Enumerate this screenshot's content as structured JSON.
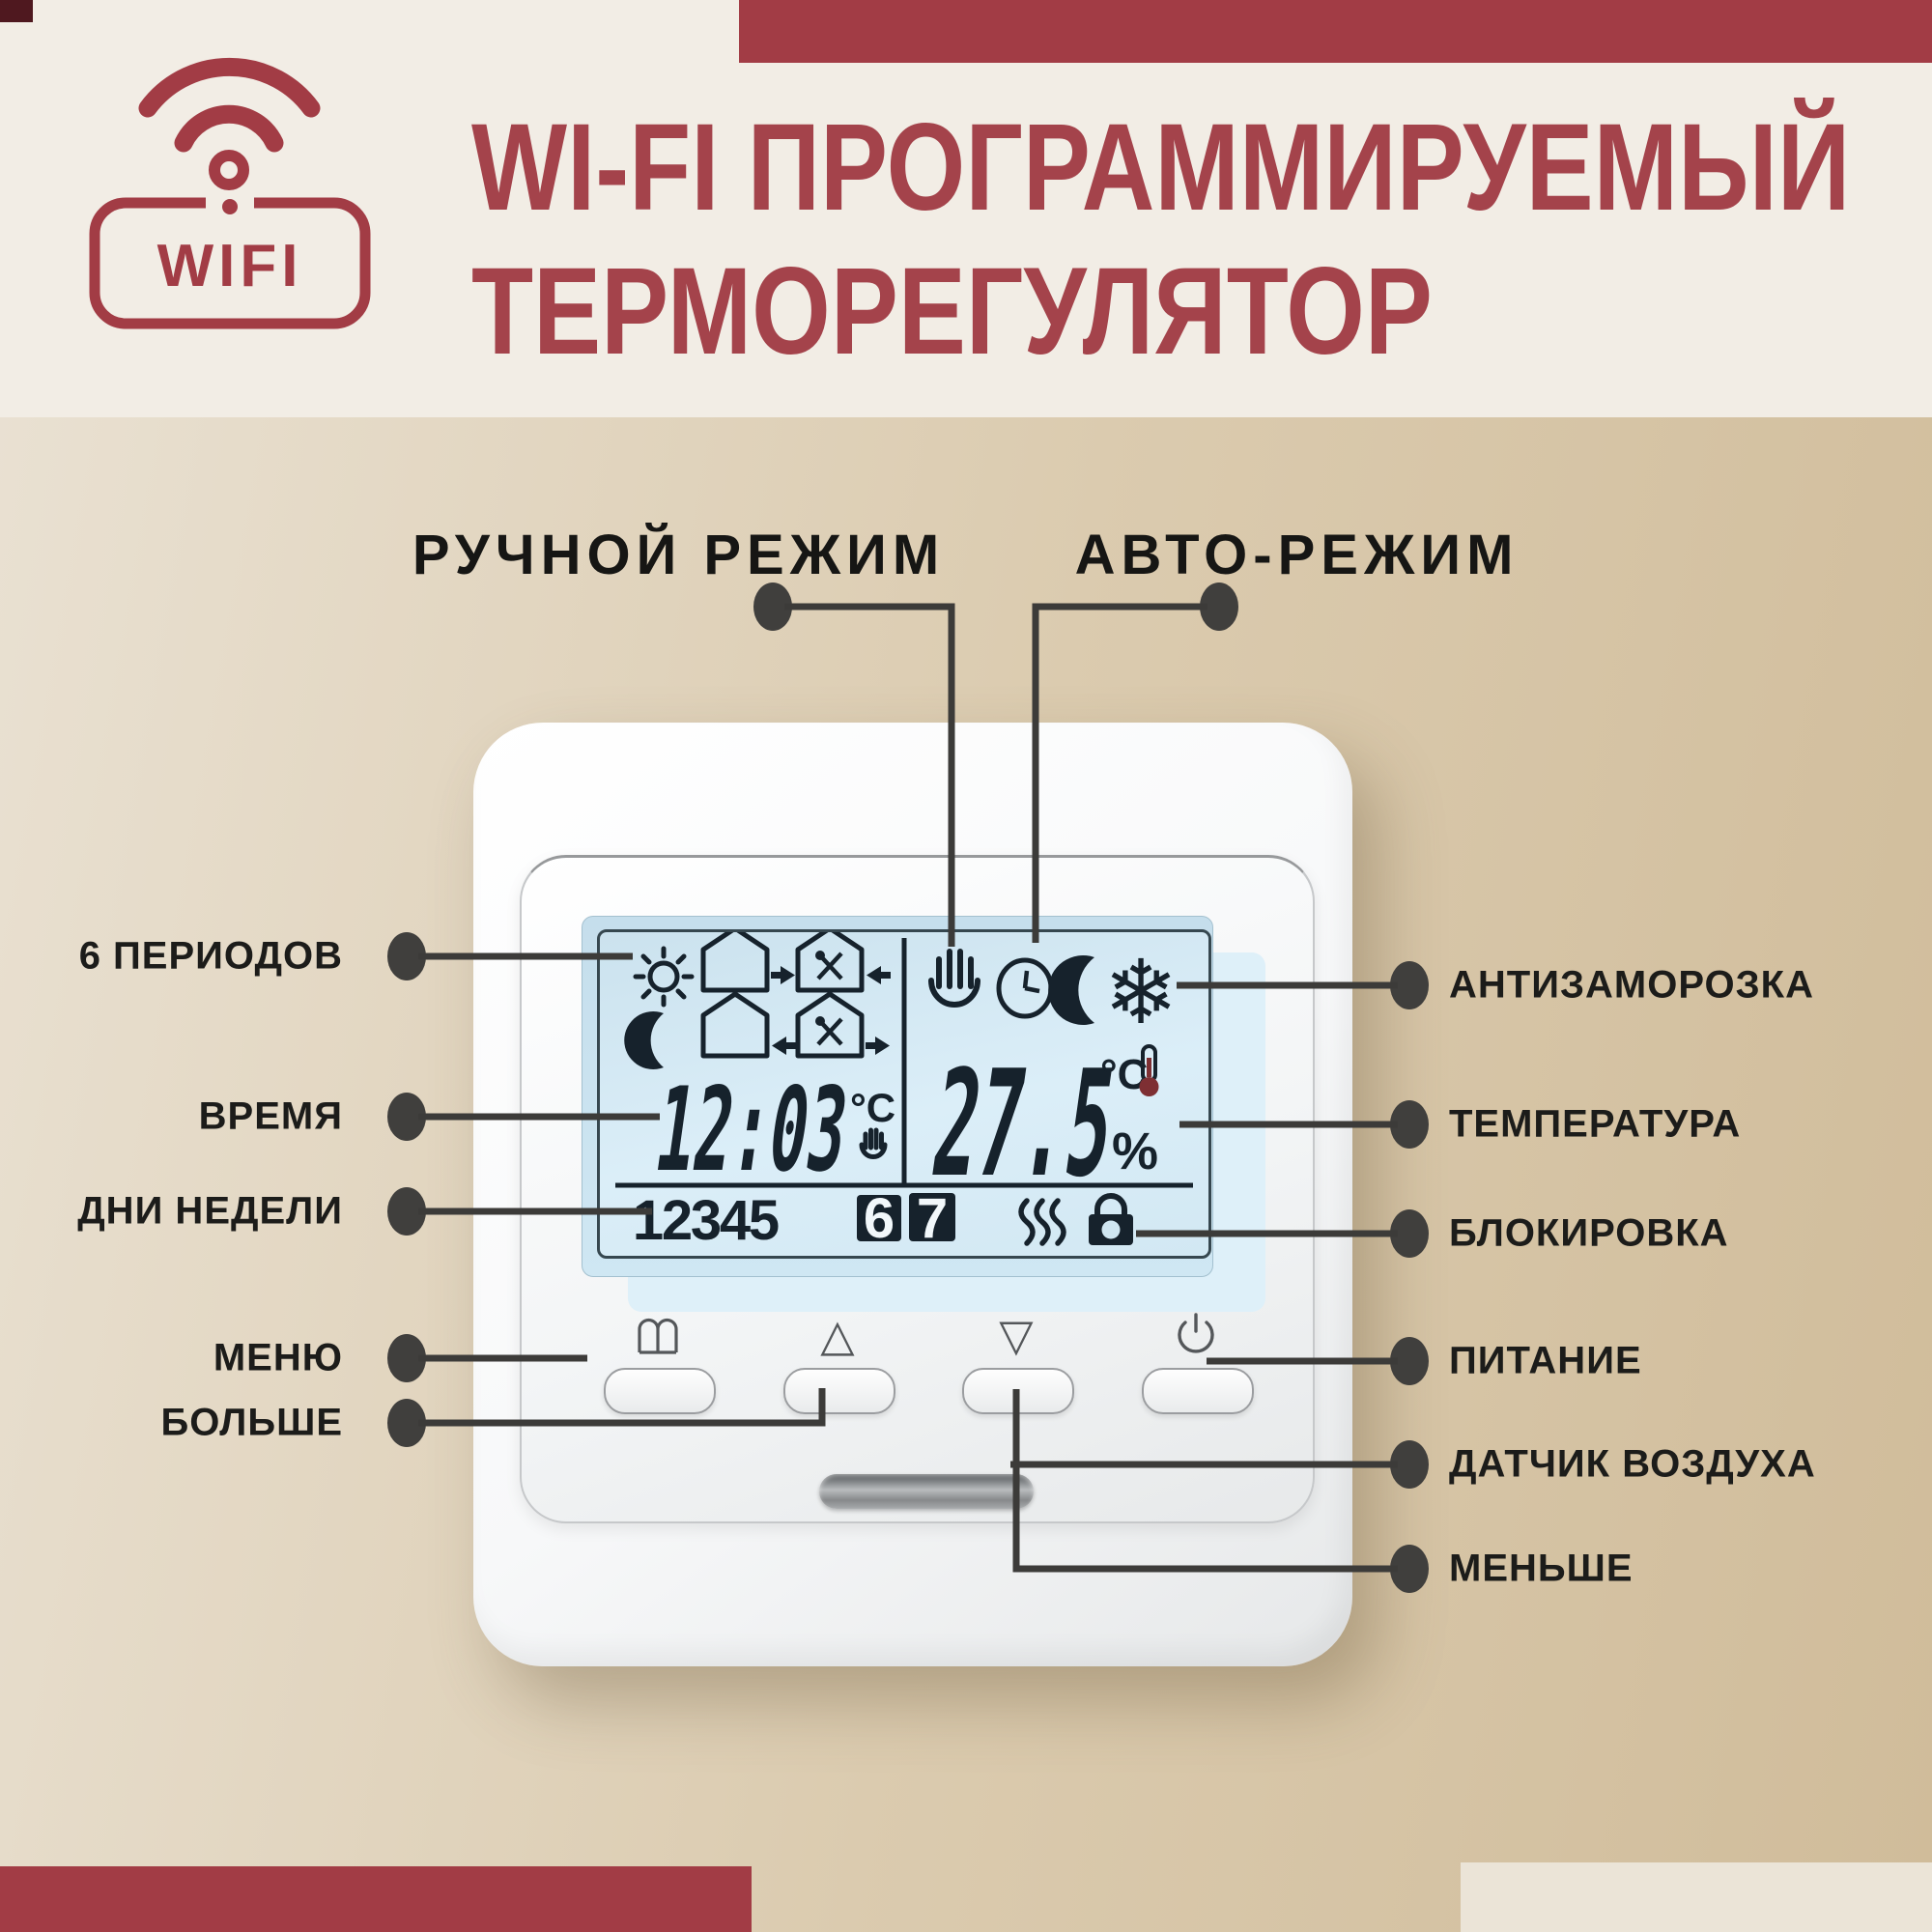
{
  "header": {
    "title_line1": "WI-FI ПРОГРАММИРУЕМЫЙ",
    "title_line2": "ТЕРМОРЕГУЛЯТОР",
    "wifi_badge_text": "WIFI",
    "accent_color": "#a23c45",
    "title_color": "#a4434b"
  },
  "mode_labels": {
    "manual": "РУЧНОЙ РЕЖИМ",
    "auto": "АВТО-РЕЖИМ"
  },
  "callouts": {
    "left": [
      {
        "label": "6 ПЕРИОДОВ"
      },
      {
        "label": "ВРЕМЯ"
      },
      {
        "label": "ДНИ НЕДЕЛИ"
      },
      {
        "label": "МЕНЮ"
      },
      {
        "label": "БОЛЬШЕ"
      }
    ],
    "right": [
      {
        "label": "АНТИЗАМОРОЗКА"
      },
      {
        "label": "ТЕМПЕРАТУРА"
      },
      {
        "label": "БЛОКИРОВКА"
      },
      {
        "label": "ПИТАНИЕ"
      },
      {
        "label": "ДАТЧИК ВОЗДУХА"
      },
      {
        "label": "МЕНЬШЕ"
      }
    ]
  },
  "thermostat": {
    "lcd": {
      "time": "12:03",
      "time_unit": "°C",
      "temperature": "27.5",
      "temp_unit": "°C",
      "percent": "%",
      "days": [
        "1",
        "2",
        "3",
        "4",
        "5",
        "6",
        "7"
      ],
      "active_days": [
        "6",
        "7"
      ],
      "snowflake_glyph": "❄",
      "left_icons": [
        "sun",
        "house-arrow-out",
        "house-dining-arrow-in",
        "moon",
        "house-arrow-in",
        "house-dining-arrow-out"
      ],
      "mode_icons": [
        "hand-manual",
        "clock-auto",
        "moon-night",
        "snowflake-antifreeze"
      ],
      "status_icons": [
        "heating-waves",
        "lock"
      ]
    },
    "buttons": [
      {
        "name": "menu",
        "glyph": ""
      },
      {
        "name": "up",
        "glyph": "△"
      },
      {
        "name": "down",
        "glyph": "▽"
      },
      {
        "name": "power",
        "glyph": ""
      }
    ]
  }
}
